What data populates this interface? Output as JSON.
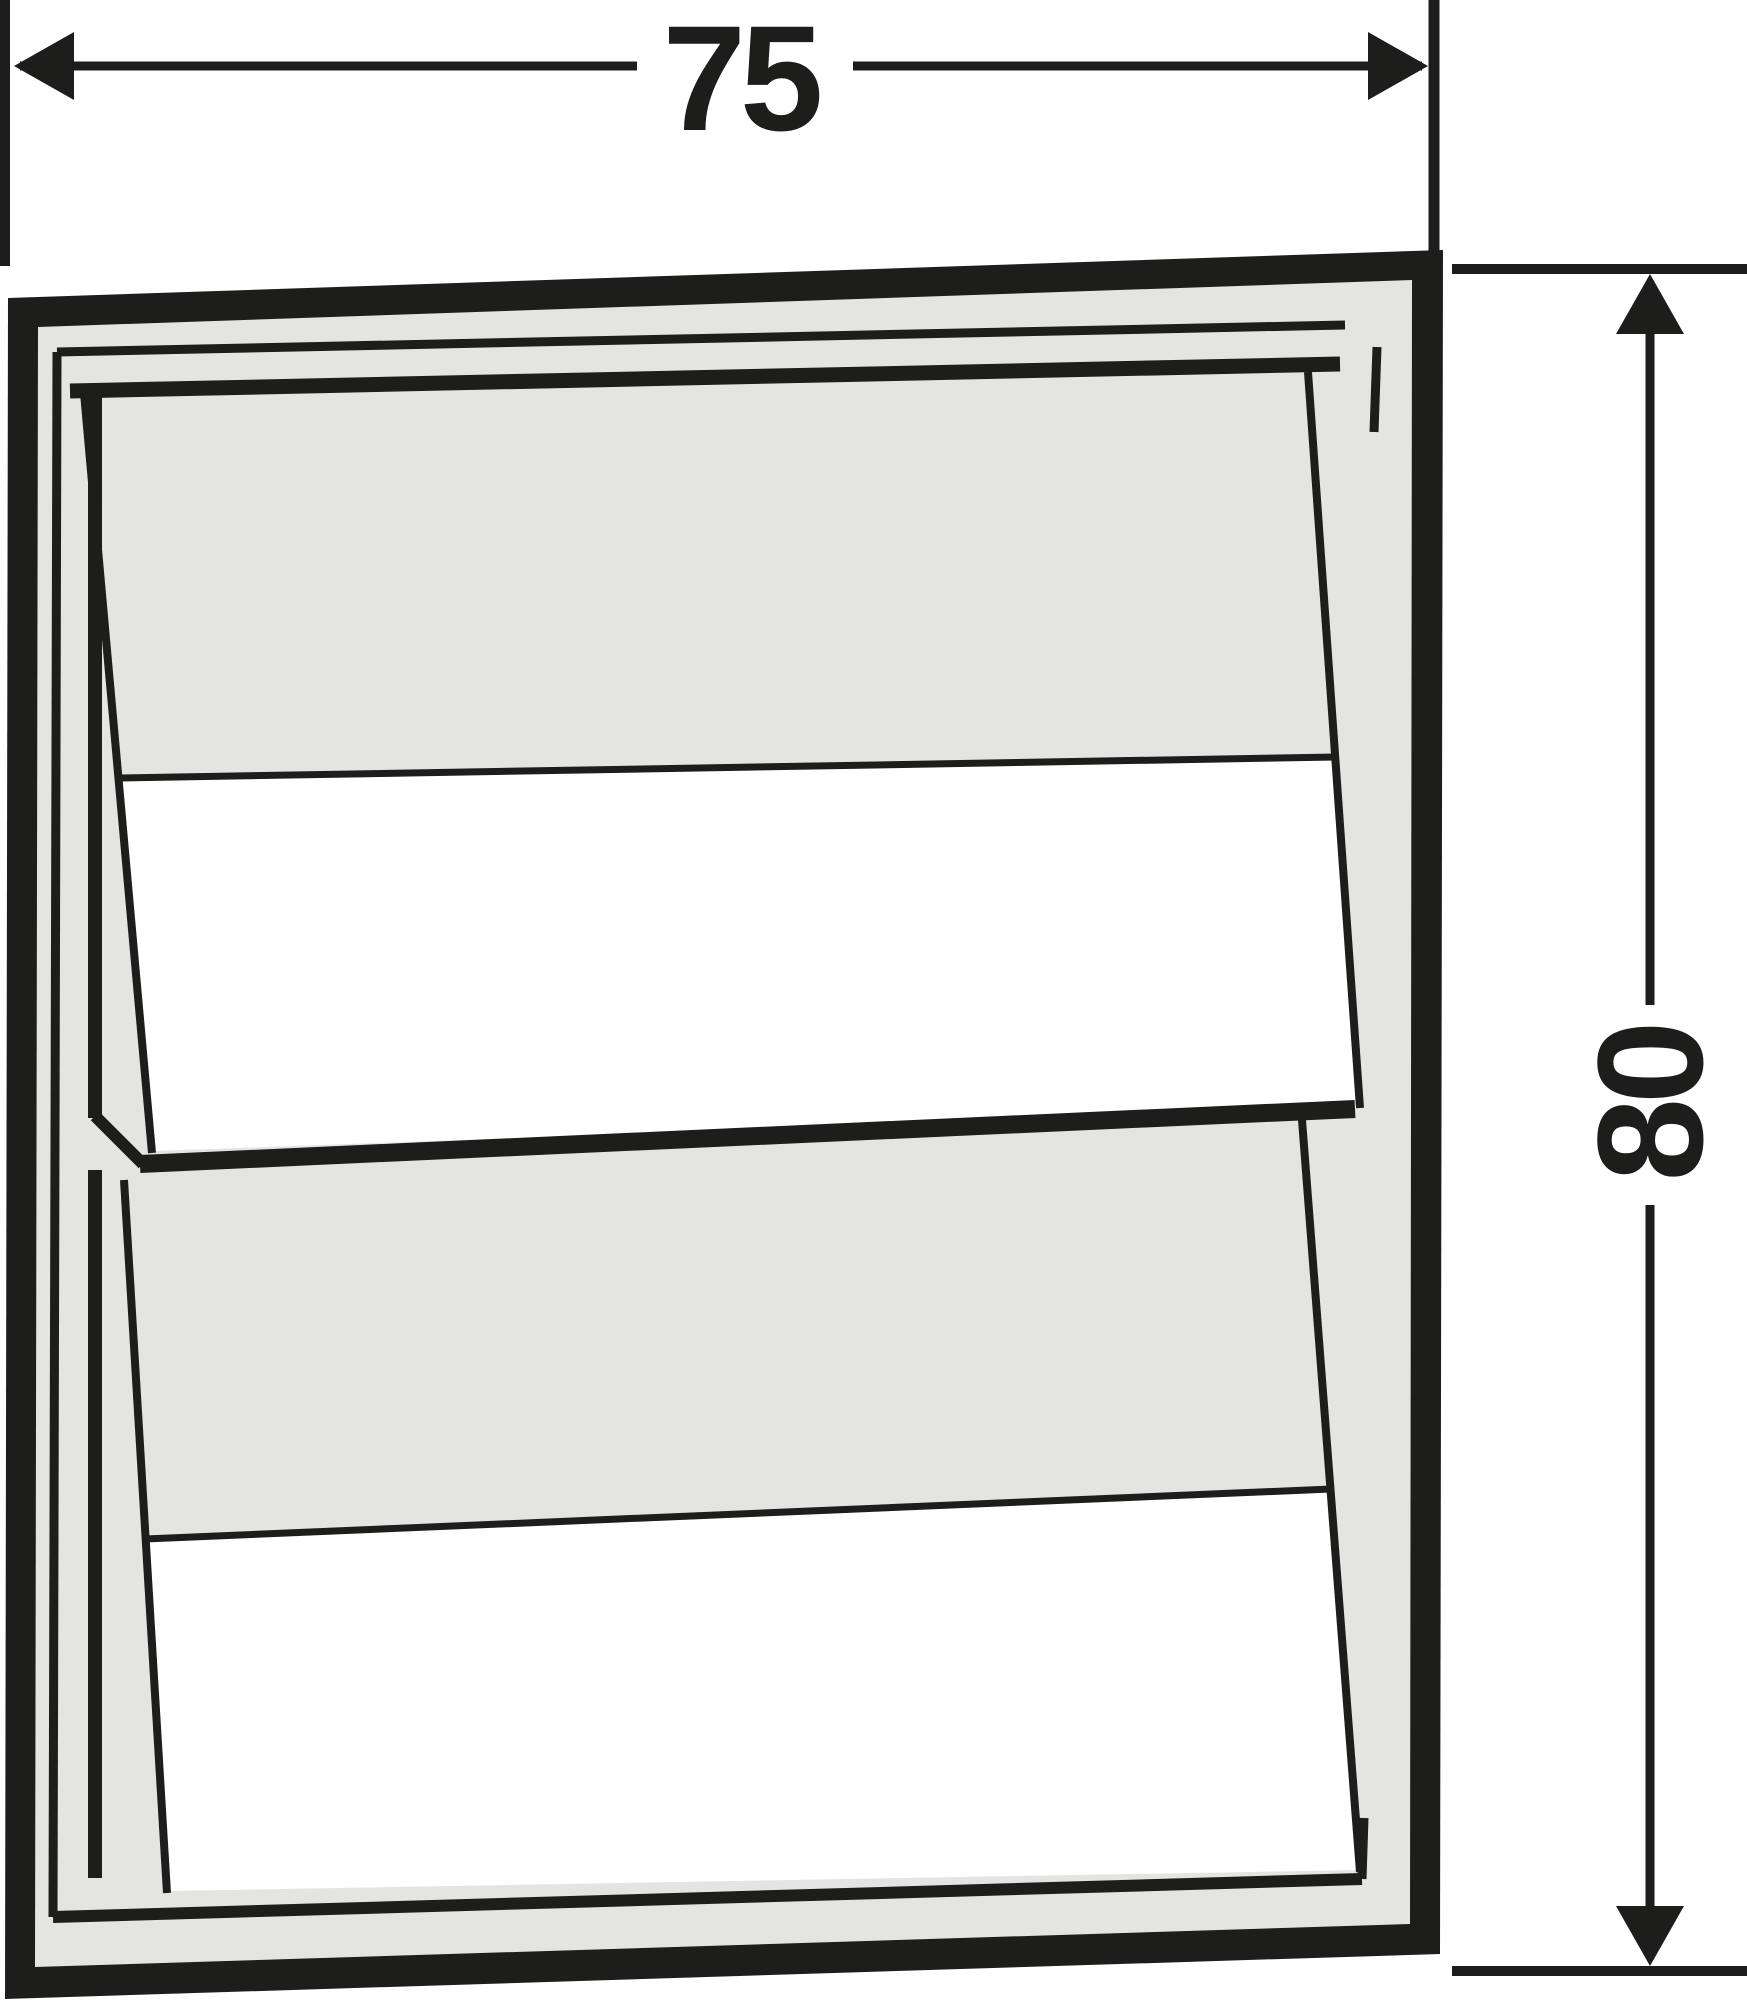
{
  "drawing": {
    "kind": "technical line drawing of a louvered vent shutter with two tilted blades",
    "colors": {
      "line_black": "#1d1d1b",
      "panel_gray": "#e4e4e3",
      "opening_white": "#ffffff",
      "background": "#ffffff"
    },
    "dimension_width_label": "75",
    "dimension_height_label": "80"
  }
}
